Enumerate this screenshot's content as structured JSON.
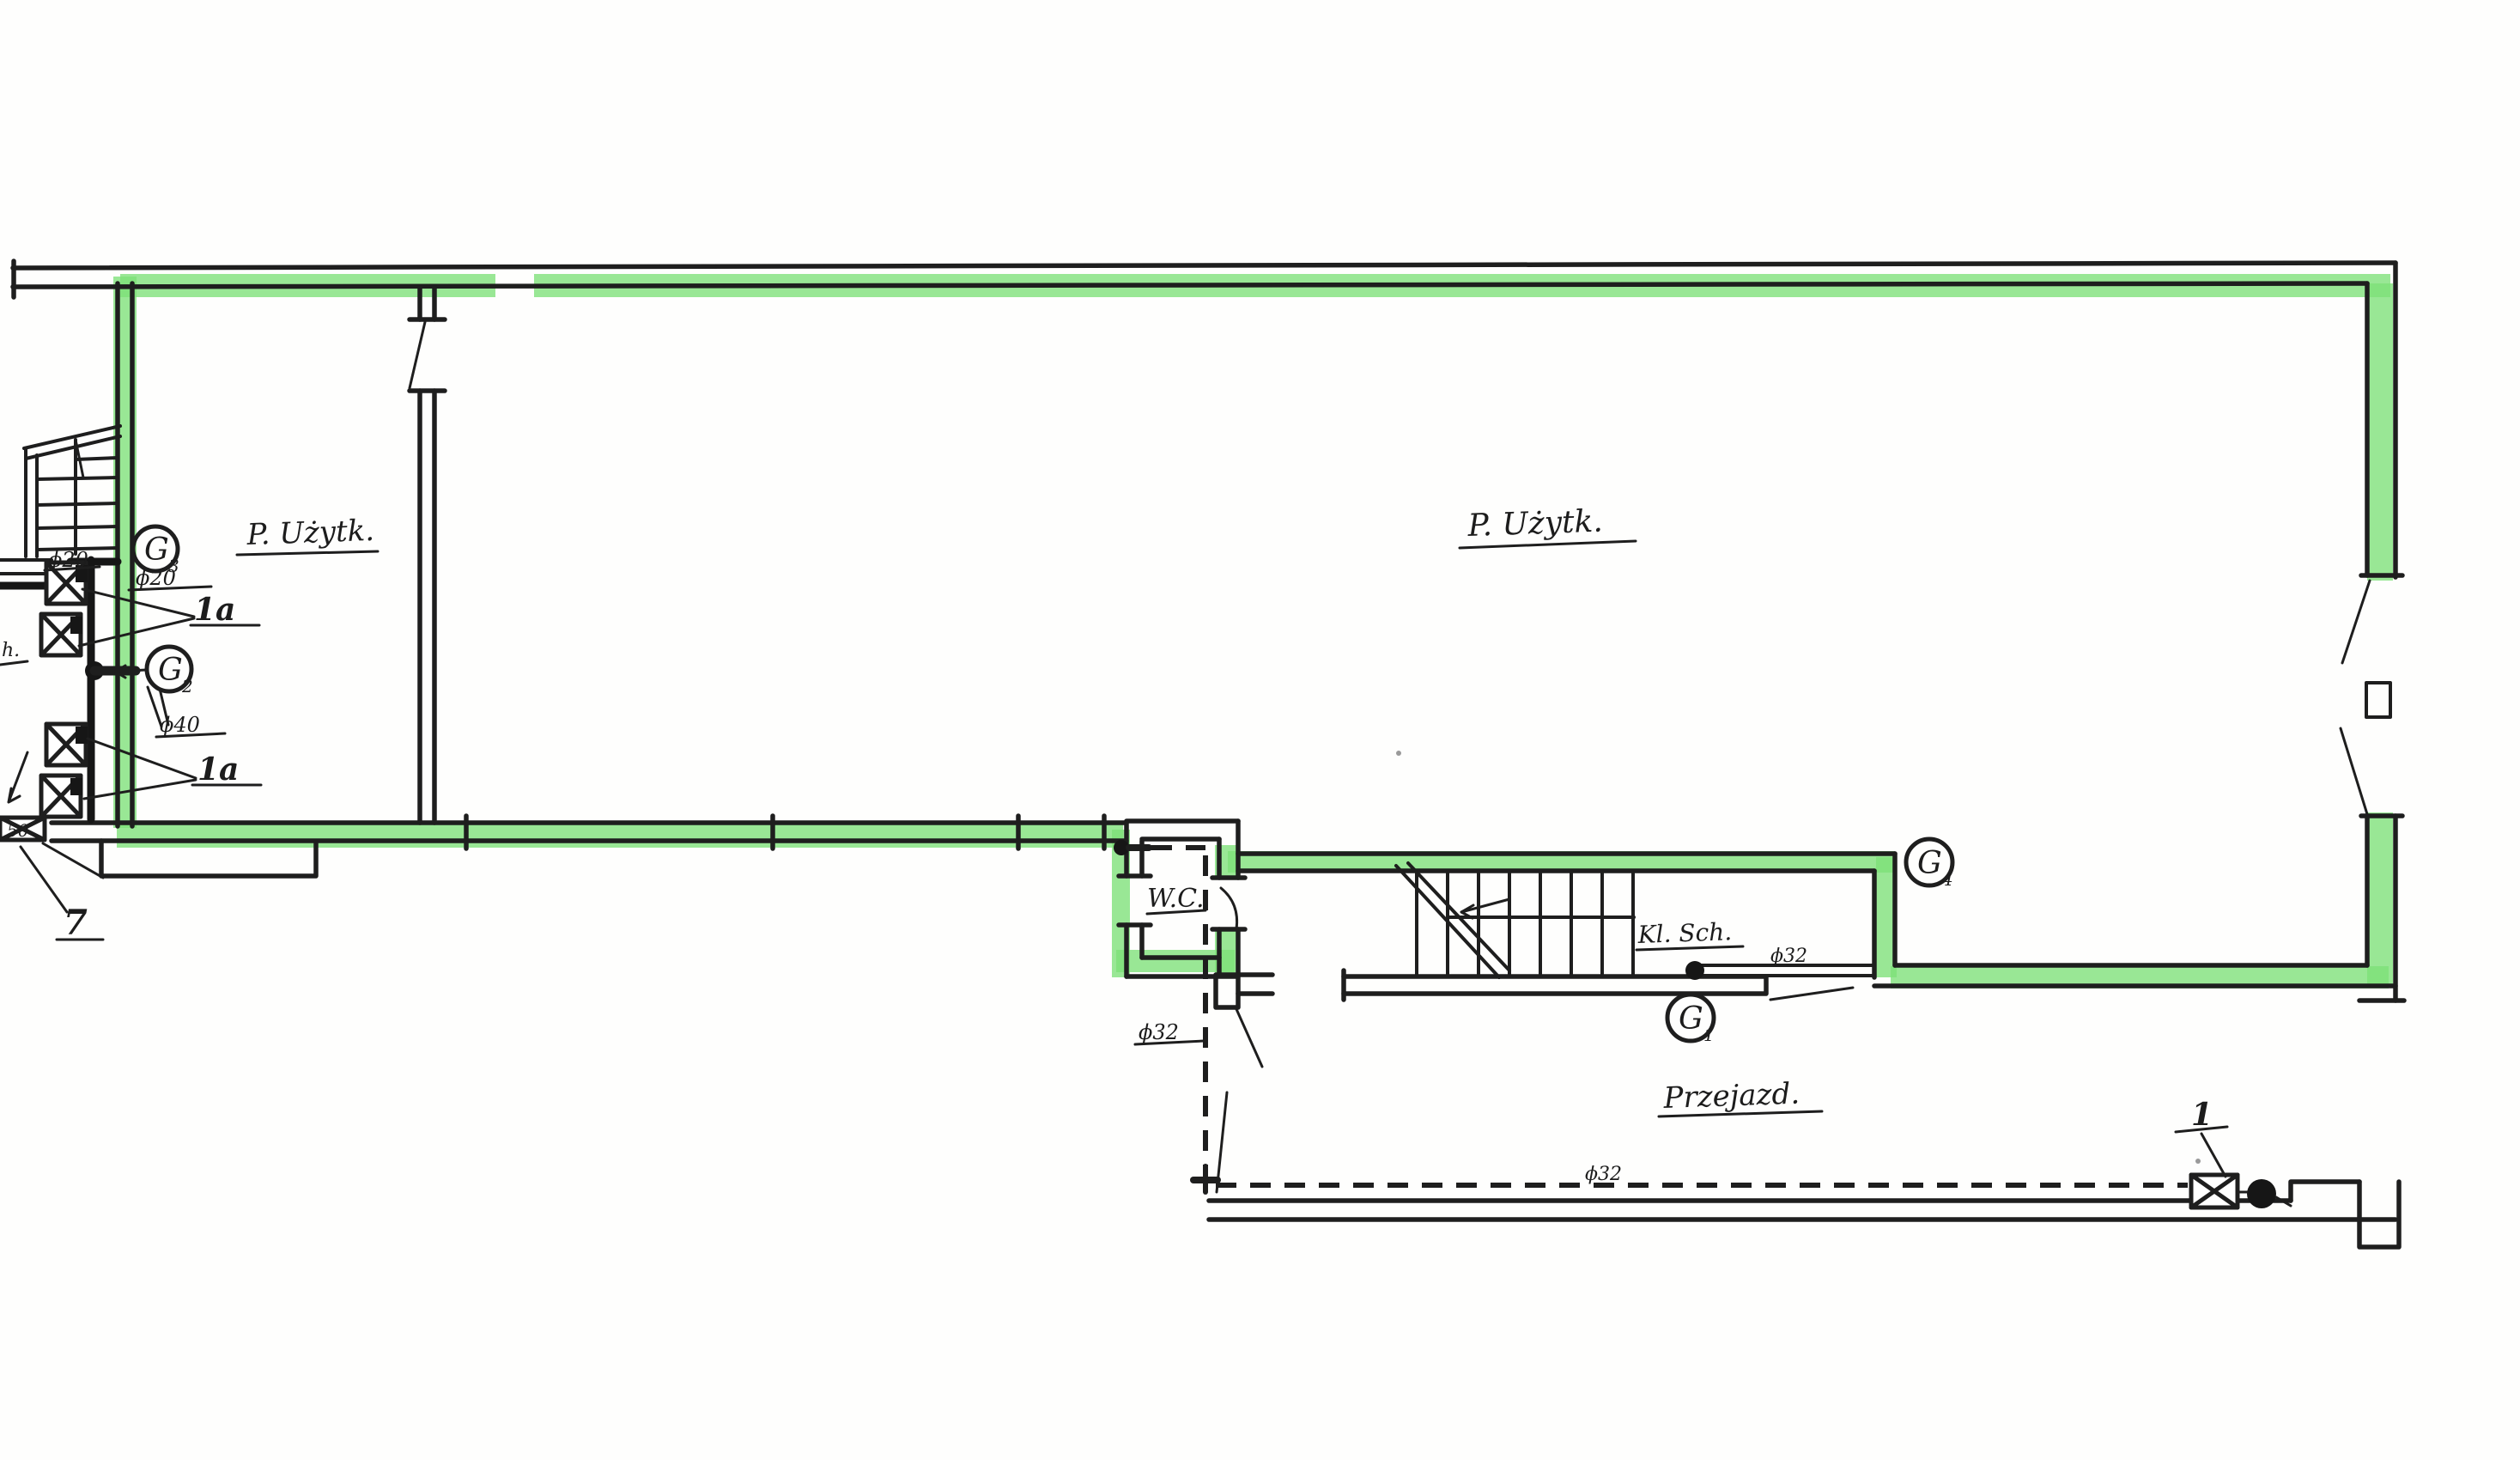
{
  "document": {
    "kind": "hand-drawn gas installation floor plan (scan)",
    "paper_color": "#fefefd",
    "ink_color": "#1e1e1e",
    "highlight_color": "#7ce077"
  },
  "rooms": {
    "p_uzytk_left": "P. Użytk.",
    "p_uzytk_right": "P. Użytk.",
    "wc": "W.C.",
    "kl_sch": "Kl. Sch.",
    "przejazd": "Przejazd."
  },
  "pipe_labels": {
    "phi20_branch": "ϕ20",
    "phi20_riser": "ϕ20",
    "phi40": "ϕ40",
    "phi32_wc": "ϕ32",
    "phi32_stairs": "ϕ32",
    "phi32_passage": "ϕ32"
  },
  "callouts": {
    "meter_upper": "1a",
    "meter_lower": "1a",
    "valve_7": "7",
    "valve_1": "1",
    "size_50": "50",
    "partial_left": "h."
  },
  "gauges": [
    {
      "id": "G3",
      "letter": "G",
      "sub": "3"
    },
    {
      "id": "G2",
      "letter": "G",
      "sub": "2"
    },
    {
      "id": "G1",
      "letter": "G",
      "sub": "1"
    },
    {
      "id": "G4",
      "letter": "G",
      "sub": "4"
    }
  ]
}
